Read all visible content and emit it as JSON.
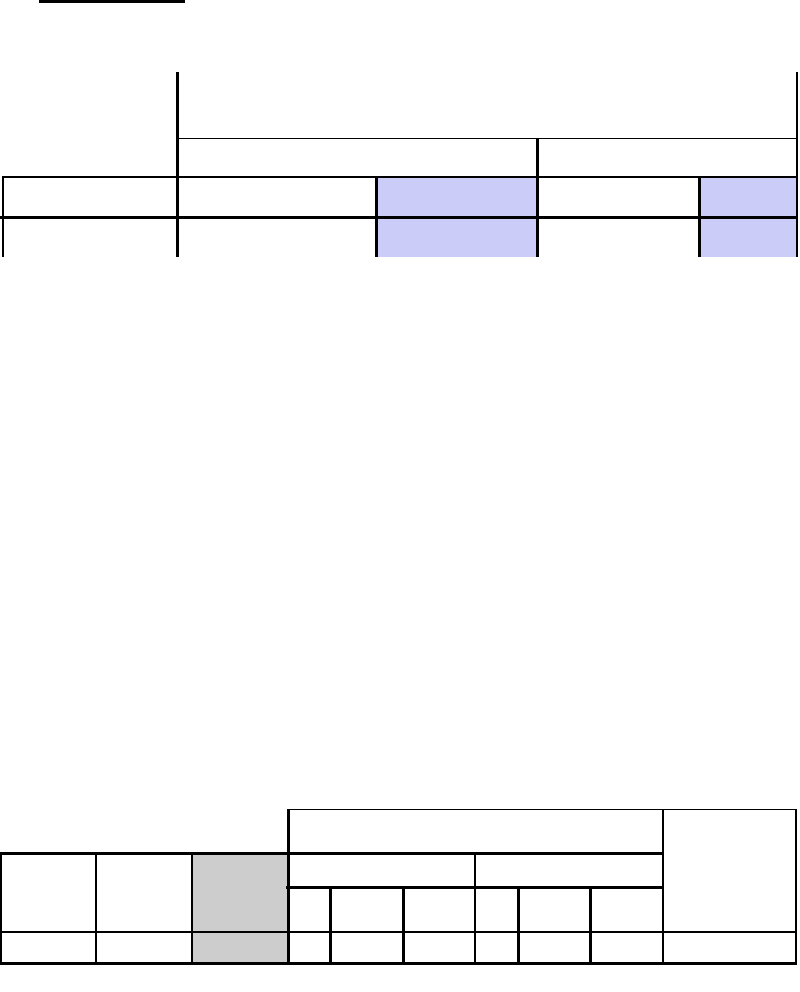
{
  "page": {
    "width_px": 800,
    "height_px": 992,
    "kind": "blank document page with two empty ruled tables"
  },
  "colors": {
    "page_bg": "#ffffff",
    "border": "#000000",
    "upper_highlight": "#ccccf8",
    "lower_highlight": "#cdcdcd"
  },
  "heading": {
    "underline_visible": true,
    "text": ""
  },
  "upper_table": {
    "row_count": 4,
    "column_count": 5,
    "all_cells_empty": true,
    "shaded_fill": "#ccccf8",
    "shaded_regions": [
      "column-3 rows 3-4",
      "column-5 rows 3-4"
    ]
  },
  "lower_table": {
    "header_levels": 3,
    "data_row_count": 1,
    "all_cells_empty": true,
    "shaded_fill": "#cdcdcd",
    "shaded_regions": [
      "column-3 header cell and data cell"
    ]
  }
}
